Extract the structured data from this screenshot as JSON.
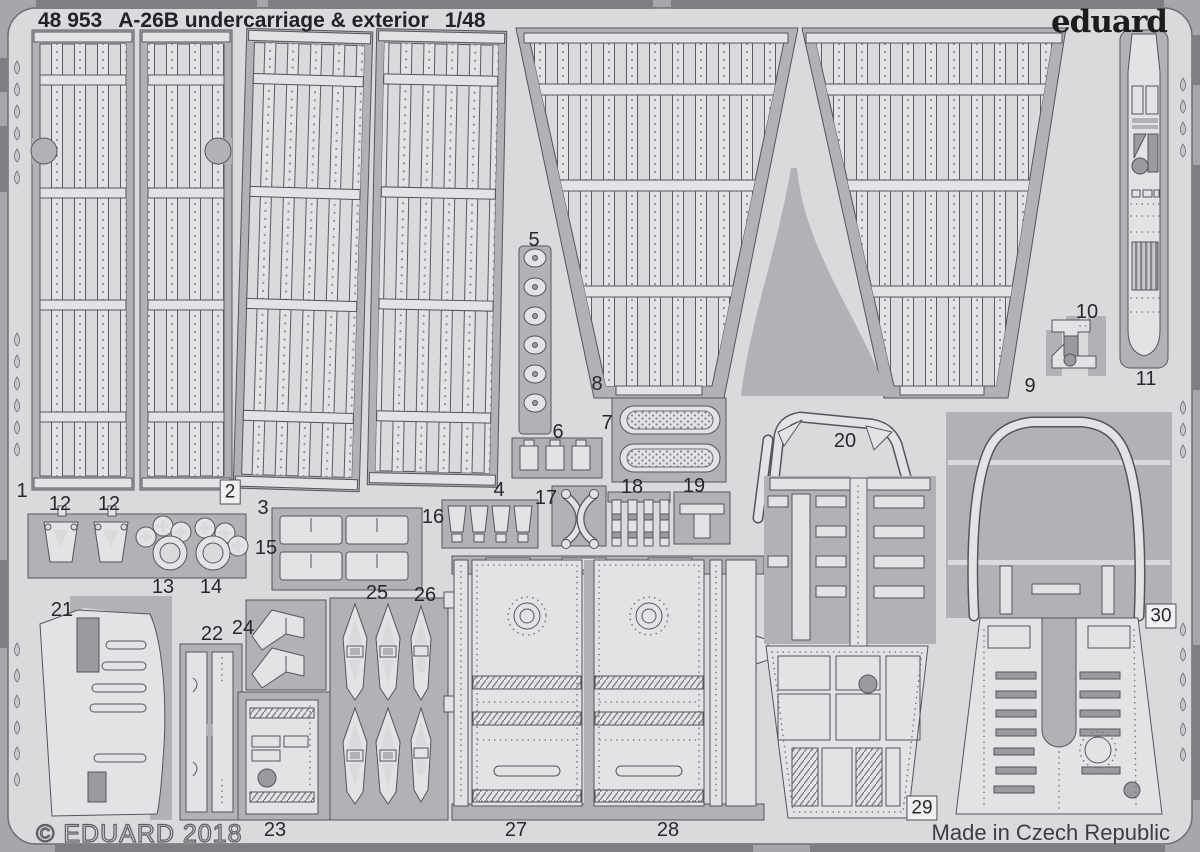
{
  "header": {
    "catalog_number": "48 953",
    "title": "A-26B undercarriage & exterior",
    "scale": "1/48",
    "brand": "eduard"
  },
  "footer": {
    "copyright": "© EDUARD 2018",
    "made_in": "Made in Czech Republic"
  },
  "colors": {
    "background": "#a6a7aa",
    "sheet": "#d9dadc",
    "part": "#e2e3e5",
    "waste": "#b1b2b6",
    "outline": "#54555a",
    "detail": "#9a9b9f",
    "text": "#27282b"
  },
  "part_labels": [
    {
      "n": "1",
      "x": 22,
      "y": 491
    },
    {
      "n": "12",
      "x": 60,
      "y": 504
    },
    {
      "n": "12",
      "x": 109,
      "y": 504
    },
    {
      "n": "2",
      "x": 230,
      "y": 492,
      "boxed": true
    },
    {
      "n": "3",
      "x": 263,
      "y": 508
    },
    {
      "n": "15",
      "x": 266,
      "y": 548
    },
    {
      "n": "13",
      "x": 163,
      "y": 587
    },
    {
      "n": "14",
      "x": 211,
      "y": 587
    },
    {
      "n": "16",
      "x": 433,
      "y": 517
    },
    {
      "n": "25",
      "x": 377,
      "y": 593
    },
    {
      "n": "26",
      "x": 425,
      "y": 595
    },
    {
      "n": "4",
      "x": 499,
      "y": 490
    },
    {
      "n": "17",
      "x": 546,
      "y": 498
    },
    {
      "n": "18",
      "x": 632,
      "y": 487
    },
    {
      "n": "19",
      "x": 694,
      "y": 486
    },
    {
      "n": "5",
      "x": 534,
      "y": 240
    },
    {
      "n": "6",
      "x": 558,
      "y": 432
    },
    {
      "n": "7",
      "x": 607,
      "y": 423
    },
    {
      "n": "8",
      "x": 597,
      "y": 384
    },
    {
      "n": "9",
      "x": 1030,
      "y": 386
    },
    {
      "n": "10",
      "x": 1087,
      "y": 312
    },
    {
      "n": "11",
      "x": 1146,
      "y": 379
    },
    {
      "n": "20",
      "x": 845,
      "y": 441
    },
    {
      "n": "21",
      "x": 62,
      "y": 610
    },
    {
      "n": "22",
      "x": 212,
      "y": 634
    },
    {
      "n": "24",
      "x": 243,
      "y": 628
    },
    {
      "n": "23",
      "x": 275,
      "y": 830
    },
    {
      "n": "27",
      "x": 516,
      "y": 830
    },
    {
      "n": "28",
      "x": 668,
      "y": 830
    },
    {
      "n": "29",
      "x": 922,
      "y": 808,
      "boxed": true
    },
    {
      "n": "30",
      "x": 1161,
      "y": 616,
      "boxed": true
    }
  ]
}
